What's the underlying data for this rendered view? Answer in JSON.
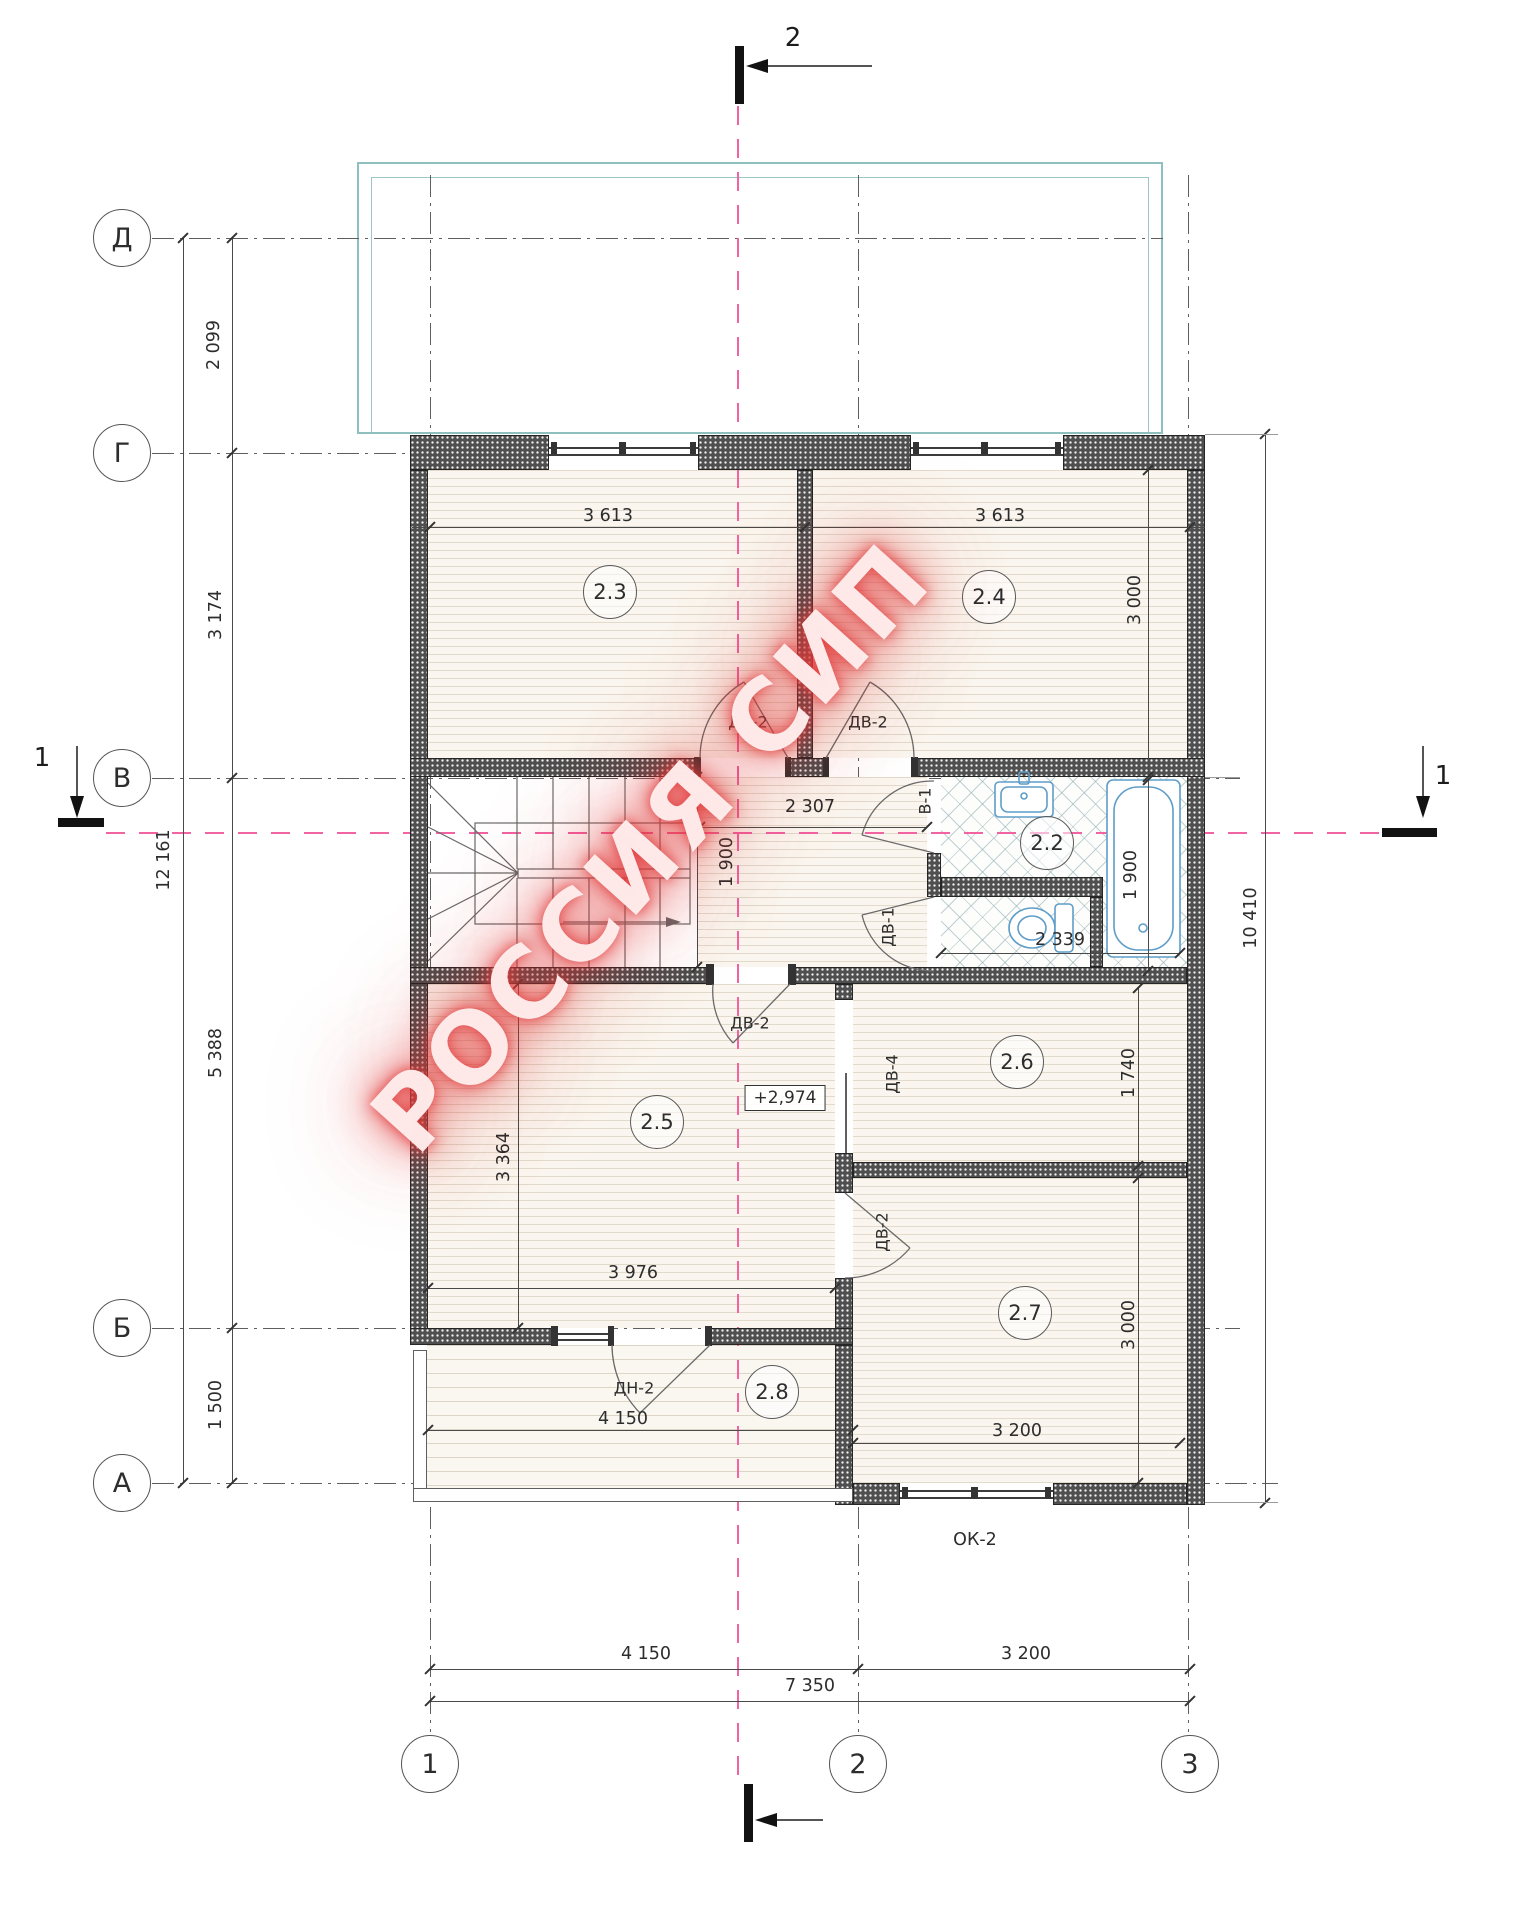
{
  "drawing": {
    "watermark": "РОССИЯ СИП",
    "elevation_mark": "+2,974",
    "axes": {
      "rows": [
        "Д",
        "Г",
        "В",
        "Б",
        "А"
      ],
      "cols": [
        "1",
        "2",
        "3"
      ]
    },
    "sections": {
      "top": "2",
      "left": "1",
      "right": "1"
    },
    "rooms": {
      "r22": "2.2",
      "r23": "2.3",
      "r24": "2.4",
      "r25": "2.5",
      "r26": "2.6",
      "r27": "2.7",
      "r28": "2.8"
    },
    "openings": {
      "door23": "ДВ-2",
      "door24": "ДВ-2",
      "door_bath": "В-1",
      "door_wc": "ДВ-1",
      "door25": "ДВ-2",
      "door26": "ДВ-4",
      "door27": "ДВ-2",
      "door28": "ДН-2",
      "window_ok2": "ОК-2"
    },
    "dims": {
      "left_seg_dg": "2 099",
      "left_seg_gv": "3 174",
      "left_seg_vb": "5 388",
      "left_seg_ba": "1 500",
      "left_total": "12 161",
      "bottom_seg_12": "4 150",
      "bottom_seg_23": "3 200",
      "bottom_total": "7 350",
      "right_total": "10 410",
      "room23_w": "3 613",
      "room24_w": "3 613",
      "room24_h": "3 000",
      "hall_w": "2 307",
      "hall_h": "1 900",
      "bath_w": "2 339",
      "bath_h": "1 900",
      "room25_h": "3 364",
      "room25_w": "3 976",
      "room26_h": "1 740",
      "room27_w": "3 200",
      "room27_h": "3 000",
      "terrace_w": "4 150"
    }
  }
}
